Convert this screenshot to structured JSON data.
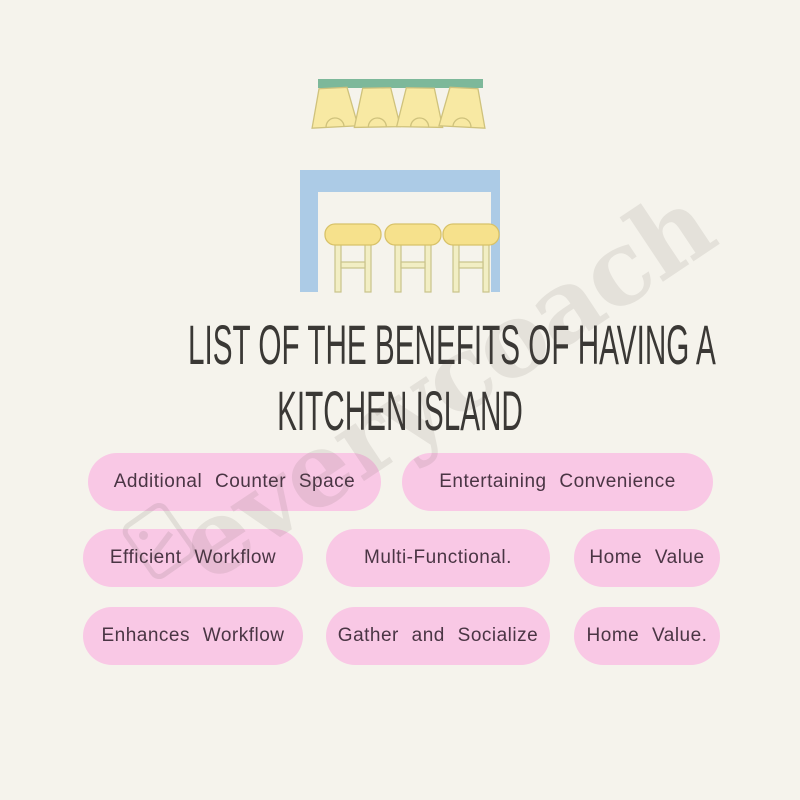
{
  "title": {
    "line1": "LIST OF THE BENEFITS OF HAVING A",
    "line2": "KITCHEN ISLAND"
  },
  "benefits": {
    "rows": [
      {
        "pills": [
          "Additional Counter Space",
          "Entertaining Convenience"
        ]
      },
      {
        "pills": [
          "Efficient Workflow",
          "Multi-Functional.",
          "Home Value"
        ]
      },
      {
        "pills": [
          "Enhances Workflow",
          "Gather and Socialize",
          "Home Value."
        ]
      }
    ]
  },
  "watermark": {
    "text": "everycoach"
  },
  "colors": {
    "background": "#f5f3ec",
    "pill_pink": "#f9c8e5",
    "pill_text": "#4a3544",
    "title_text": "#3a3835",
    "fixture_green": "#7db89a",
    "island_blue": "#accbe6",
    "lamp_yellow": "#f8e9a3",
    "stool_seat_yellow": "#f6e18c",
    "stool_leg_yellow": "#f2eec4"
  }
}
